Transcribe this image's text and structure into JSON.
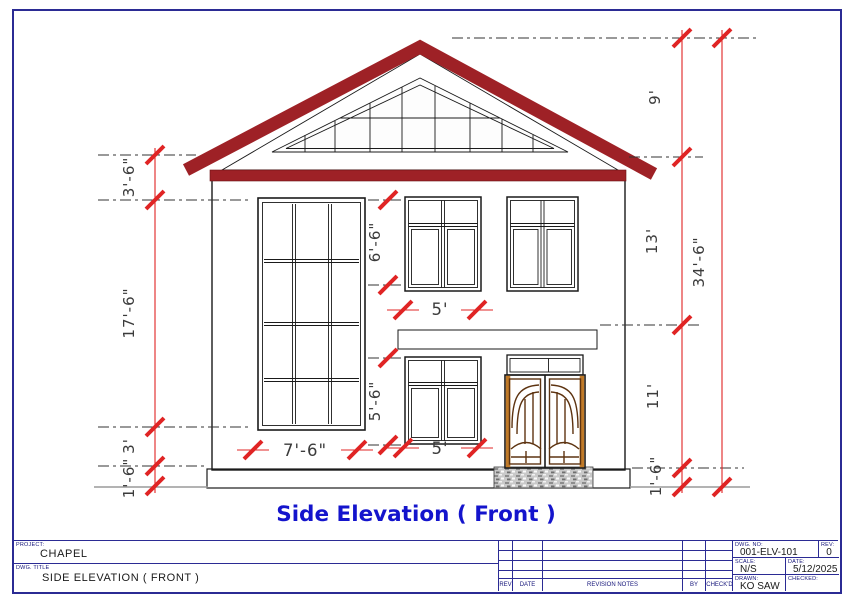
{
  "drawing": {
    "caption": "Side Elevation ( Front )"
  },
  "dims": {
    "left": [
      "3'-6\"",
      "17'-6\"",
      "3'",
      "1'-6\""
    ],
    "mid": [
      "6'-6\"",
      "5'",
      "5'-6\"",
      "5'",
      "7'-6\""
    ],
    "right": [
      "9'",
      "13'",
      "11'",
      "1'-6\""
    ],
    "overall": "34'-6\""
  },
  "colors": {
    "roof_maroon": "#9E2126",
    "dimension_red": "#E02424",
    "title_blue": "#1414CC",
    "frame_navy": "#2B2B94",
    "door_orange": "#E2973B",
    "plinth_cream": "#F5E6BF",
    "step_gray": "#C9C9C9"
  },
  "title_block": {
    "project_label": "PROJECT:",
    "project": "CHAPEL",
    "dwg_title_label": "DWG. TITLE",
    "dwg_title": "SIDE ELEVATION ( FRONT )",
    "revision_headers": [
      "REV",
      "DATE",
      "REVISION NOTES",
      "BY",
      "CHECK'D"
    ],
    "dwg_no_label": "DWG. NO:",
    "dwg_no": "001-ELV-101",
    "rev_label": "REV:",
    "rev": "0",
    "scale_label": "SCALE:",
    "scale": "N/S",
    "date_label": "DATE:",
    "date": "5/12/2025",
    "drawn_label": "DRAWN:",
    "drawn": "KO SAW",
    "checked_label": "CHECKED:",
    "checked": ""
  }
}
